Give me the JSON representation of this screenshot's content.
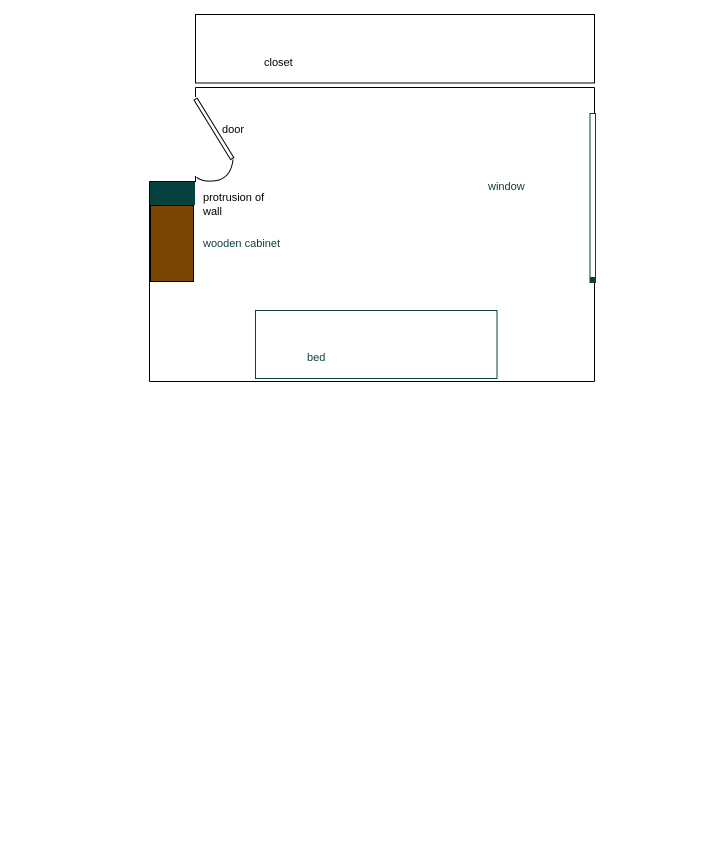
{
  "diagram": {
    "labels": {
      "closet": "closet",
      "door": "door",
      "protrusion_line1": "protrusion of",
      "protrusion_line2": "wall",
      "wooden_cabinet": "wooden cabinet",
      "window": "window",
      "bed": "bed"
    },
    "colors": {
      "background": "#ffffff",
      "wall_line": "#000000",
      "protrusion_fill": "#05423e",
      "cabinet_fill": "#7b4504",
      "cabinet_stroke": "#000000",
      "fixture_stroke": "#0d3d3d",
      "fixture_fill": "#ffffff",
      "teal_text": "#0d3d3d",
      "black_text": "#000000"
    }
  }
}
